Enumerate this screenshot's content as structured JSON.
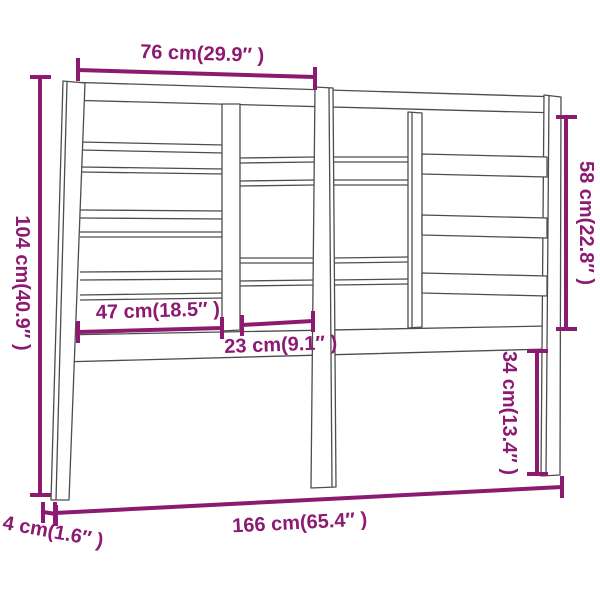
{
  "diagram": {
    "type": "product-dimension-diagram",
    "subject": "bed headboard",
    "labels": {
      "top_width": "76 cm(29.9″ )",
      "left_height": "104 cm(40.9″ )",
      "right_height": "58 cm(22.8″ )",
      "board_width": "47 cm(18.5″ )",
      "middle_gap": "23 cm(9.1″ )",
      "leg_height": "34 cm(13.4″ )",
      "total_width": "166 cm(65.4″ )",
      "depth": "4 cm(1.6″ )"
    },
    "colors": {
      "dimension": "#8d1a71",
      "drawing": "#4d4d4d",
      "background": "#ffffff"
    }
  }
}
